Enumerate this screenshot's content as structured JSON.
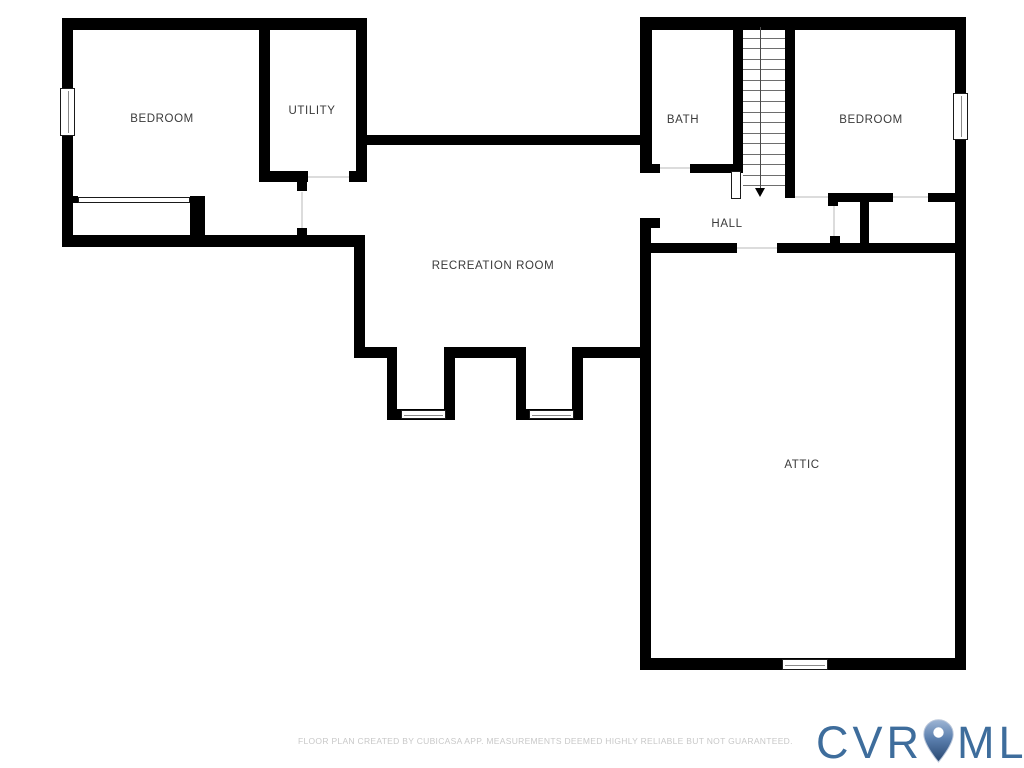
{
  "plan": {
    "wall_color": "#000000",
    "door_line_color": "#dcdcdc",
    "label_color": "#3a3a3a",
    "walls": [
      [
        62,
        18,
        305,
        12
      ],
      [
        62,
        18,
        11,
        229
      ],
      [
        259,
        30,
        11,
        152
      ],
      [
        259,
        171,
        49,
        11
      ],
      [
        349,
        171,
        18,
        11
      ],
      [
        356,
        18,
        11,
        164
      ],
      [
        62,
        196,
        16,
        7
      ],
      [
        190,
        196,
        15,
        39
      ],
      [
        62,
        235,
        303,
        12
      ],
      [
        297,
        182,
        10,
        9
      ],
      [
        297,
        228,
        10,
        7
      ],
      [
        354,
        235,
        11,
        123
      ],
      [
        354,
        347,
        43,
        11
      ],
      [
        387,
        347,
        10,
        73
      ],
      [
        387,
        409,
        68,
        11
      ],
      [
        444,
        347,
        11,
        73
      ],
      [
        444,
        347,
        82,
        11
      ],
      [
        516,
        347,
        10,
        73
      ],
      [
        516,
        409,
        67,
        11
      ],
      [
        572,
        347,
        11,
        73
      ],
      [
        572,
        347,
        79,
        11
      ],
      [
        357,
        135,
        286,
        10
      ],
      [
        640,
        17,
        326,
        13
      ],
      [
        640,
        17,
        12,
        156
      ],
      [
        640,
        164,
        20,
        9
      ],
      [
        690,
        164,
        53,
        9
      ],
      [
        733,
        17,
        10,
        154
      ],
      [
        785,
        17,
        10,
        181
      ],
      [
        828,
        193,
        65,
        9
      ],
      [
        928,
        193,
        28,
        9
      ],
      [
        828,
        193,
        10,
        13
      ],
      [
        860,
        200,
        9,
        47
      ],
      [
        830,
        236,
        10,
        9
      ],
      [
        651,
        243,
        86,
        10
      ],
      [
        777,
        243,
        179,
        10
      ],
      [
        640,
        218,
        11,
        452
      ],
      [
        651,
        218,
        9,
        10
      ],
      [
        640,
        658,
        326,
        12
      ],
      [
        955,
        17,
        11,
        653
      ]
    ],
    "windows": [
      [
        60,
        88,
        15,
        48,
        "v"
      ],
      [
        953,
        93,
        15,
        47,
        "v"
      ],
      [
        401,
        410,
        45,
        9,
        "h"
      ],
      [
        529,
        410,
        45,
        9,
        "h"
      ],
      [
        782,
        659,
        46,
        11,
        "h"
      ]
    ],
    "door_openings": [
      [
        308,
        177,
        349,
        177
      ],
      [
        302,
        192,
        302,
        228
      ],
      [
        660,
        168,
        690,
        168
      ],
      [
        737,
        248,
        777,
        248
      ],
      [
        795,
        197,
        828,
        197
      ],
      [
        893,
        197,
        928,
        197
      ],
      [
        834,
        206,
        834,
        236
      ]
    ],
    "closet_door": [
      78,
      197,
      112,
      6
    ],
    "stairs": {
      "x": 743,
      "top": 27,
      "width": 42,
      "bottom": 196,
      "treads": 15,
      "center_x": 760,
      "rail": [
        731,
        171,
        10,
        28
      ],
      "arrow": {
        "x": 760,
        "y": 188
      }
    },
    "labels": [
      {
        "id": "bedroom-left",
        "text": "BEDROOM",
        "x": 162,
        "y": 119
      },
      {
        "id": "utility",
        "text": "UTILITY",
        "x": 312,
        "y": 111
      },
      {
        "id": "bath",
        "text": "BATH",
        "x": 683,
        "y": 120
      },
      {
        "id": "bedroom-right",
        "text": "BEDROOM",
        "x": 871,
        "y": 120
      },
      {
        "id": "hall",
        "text": "HALL",
        "x": 727,
        "y": 224
      },
      {
        "id": "recreation-room",
        "text": "RECREATION ROOM",
        "x": 493,
        "y": 266
      },
      {
        "id": "attic",
        "text": "ATTIC",
        "x": 802,
        "y": 465
      }
    ]
  },
  "footer": {
    "disclaimer": "FLOOR PLAN CREATED BY CUBICASA APP. MEASUREMENTS DEEMED HIGHLY RELIABLE BUT NOT GUARANTEED."
  },
  "logo": {
    "prefix": "CVR",
    "suffix": "MLS",
    "color": "#3e6d9c",
    "pin_icon": "location-pin"
  }
}
